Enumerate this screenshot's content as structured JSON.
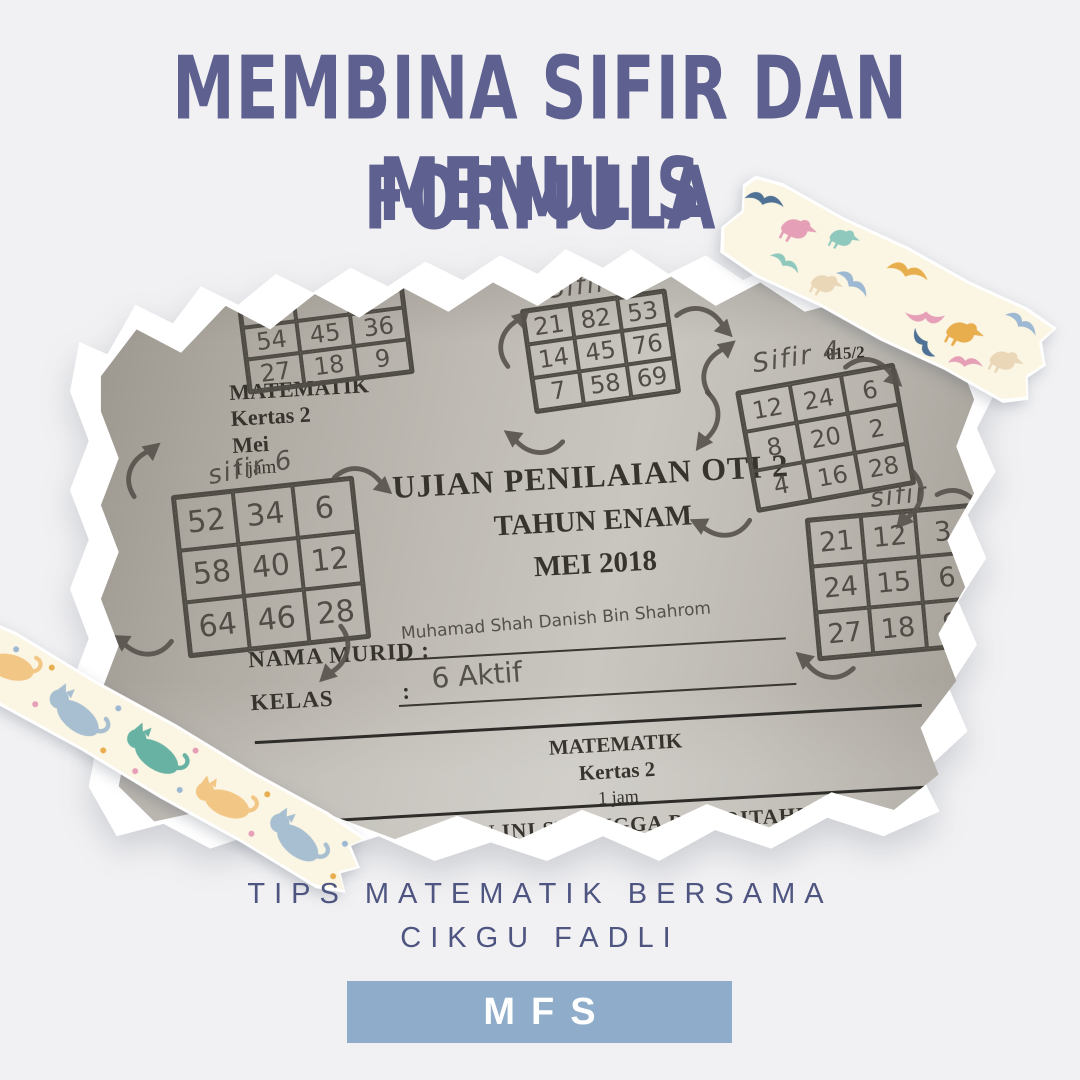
{
  "poster": {
    "title_line1": "MEMBINA SIFIR DAN MENULIS",
    "title_line2": "FORMULA",
    "tagline_line1": "TIPS MATEMATIK BERSAMA",
    "tagline_line2": "CIKGU FADLI",
    "badge_label": "MFS"
  },
  "colors": {
    "background": "#f1f1f3",
    "title_text": "#5e6190",
    "tagline_text": "#4f5581",
    "badge_background": "#8fadca",
    "badge_text": "#ffffff",
    "tape_cream": "#fbf5e3",
    "photo_paper_gray": "#bdb9b2",
    "pencil_gray": "#54504a",
    "print_ink": "#37342e"
  },
  "decorations": {
    "top_right_tape": "washi-tape-birds",
    "bottom_left_tape": "washi-tape-cats",
    "doodles": "hand-drawn-curved-arrows"
  },
  "photo": {
    "header_block": {
      "subject": "MATEMATIK",
      "paper": "Kertas 2",
      "month": "Mei",
      "duration": "1 jam"
    },
    "paper_code": "015/2",
    "exam_title_line1": "UJIAN PENILAIAN OTI 2",
    "exam_title_line2": "TAHUN ENAM",
    "exam_title_line3": "MEI 2018",
    "name_label": "NAMA MURID",
    "colon": ":",
    "name_value": "Muhamad Shah Danish Bin Shahrom",
    "class_label": "KELAS",
    "class_value": "6 Aktif",
    "footer_block": {
      "subject": "MATEMATIK",
      "paper": "Kertas 2",
      "duration": "1 jam"
    },
    "torn_bottom_text": "ALAN INI SEHINGGA DIBERITAHU",
    "grids": [
      {
        "label": "",
        "cells": [
          [
            "",
            "",
            "3"
          ],
          [
            "54",
            "45",
            "36"
          ],
          [
            "27",
            "18",
            "9"
          ]
        ]
      },
      {
        "label": "Sifir 7",
        "cells": [
          [
            "21",
            "82",
            "53"
          ],
          [
            "14",
            "45",
            "76"
          ],
          [
            "7",
            "58",
            "69"
          ]
        ]
      },
      {
        "label": "sifir 6",
        "cells": [
          [
            "52",
            "34",
            "6"
          ],
          [
            "58",
            "40",
            "12"
          ],
          [
            "64",
            "46",
            "28"
          ]
        ]
      },
      {
        "label": "Sifir 4",
        "cells": [
          [
            "12",
            "24",
            "6"
          ],
          [
            "8",
            "20",
            "2"
          ],
          [
            "4",
            "16",
            "28"
          ]
        ]
      },
      {
        "label": "sifir",
        "cells": [
          [
            "21",
            "12",
            "3"
          ],
          [
            "24",
            "15",
            "6"
          ],
          [
            "27",
            "18",
            "9"
          ]
        ]
      }
    ]
  }
}
